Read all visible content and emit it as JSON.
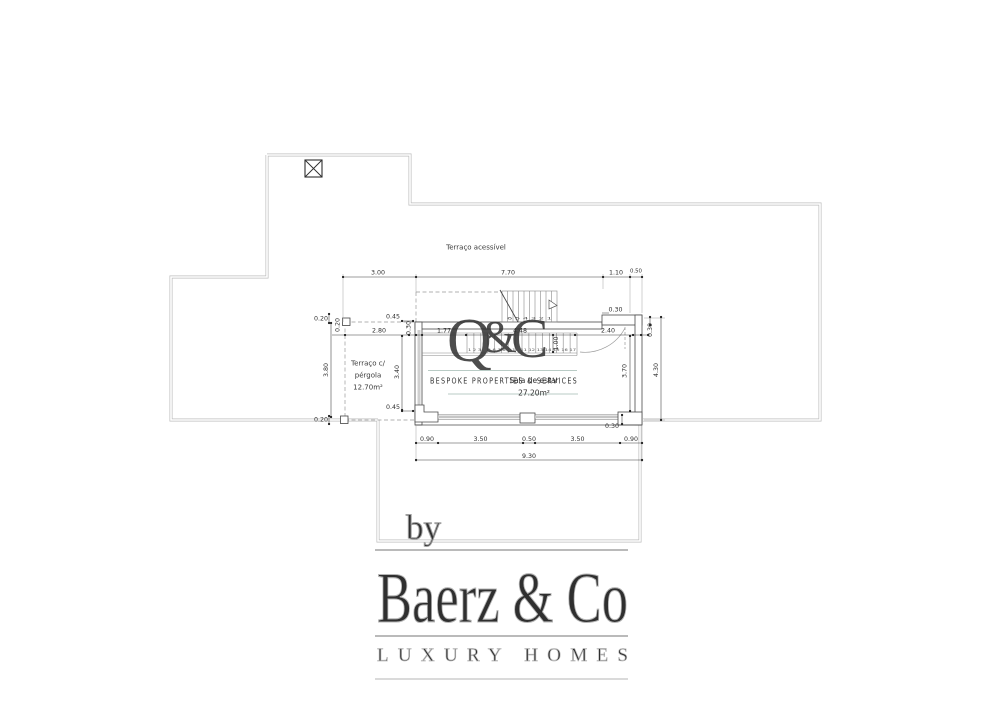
{
  "plan": {
    "terrace_label": "Terraço acessível",
    "pergola_label": {
      "line1": "Terraço c/",
      "line2": "pérgola",
      "area": "12.70m²"
    },
    "living_room": {
      "name": "Sala de estar",
      "area": "27.20m²"
    },
    "dims": {
      "top": {
        "a": "3.00",
        "b": "7.70",
        "c": "1.10",
        "d": "0.50"
      },
      "pergola": {
        "h020_top": "0.20",
        "v020": "0.20",
        "h045_top": "0.45",
        "w280": "2.80",
        "v030": "0.30",
        "v380": "3.80",
        "v340": "3.40",
        "h045_bot": "0.45",
        "h020_bot": "0.20"
      },
      "interior": {
        "w177": "1.77",
        "w448": "4.48",
        "w240": "2.40",
        "v100": "1.00",
        "v030_right": "0.30"
      },
      "right": {
        "t030": "0.30",
        "v370": "3.70",
        "v430": "4.30",
        "b030": "0.30"
      },
      "bottom": {
        "a": "0.90",
        "b": "3.50",
        "c": "0.50",
        "d": "3.50",
        "e": "0.90",
        "total": "9.30"
      }
    },
    "stairs": {
      "upper_numbers": "6 5 4 3 2 1",
      "lower_numbers": "1 2 3 4 5 6 7 8 9 10 11 12 13 14 15 16 17"
    }
  },
  "watermarks": {
    "monogram": {
      "q": "Q",
      "amp": "&",
      "c": "C"
    },
    "tagline": "BESPOKE PROPERTIES & SERVICES",
    "by": "by",
    "brand": "Baerz & Co",
    "brand_tagline": "LUXURY HOMES",
    "colors": {
      "sage": "#7E9C95",
      "sage_light": "#A9BEB7",
      "gold": "#D0B46A",
      "logo_gray": "#B5B5B5"
    }
  }
}
